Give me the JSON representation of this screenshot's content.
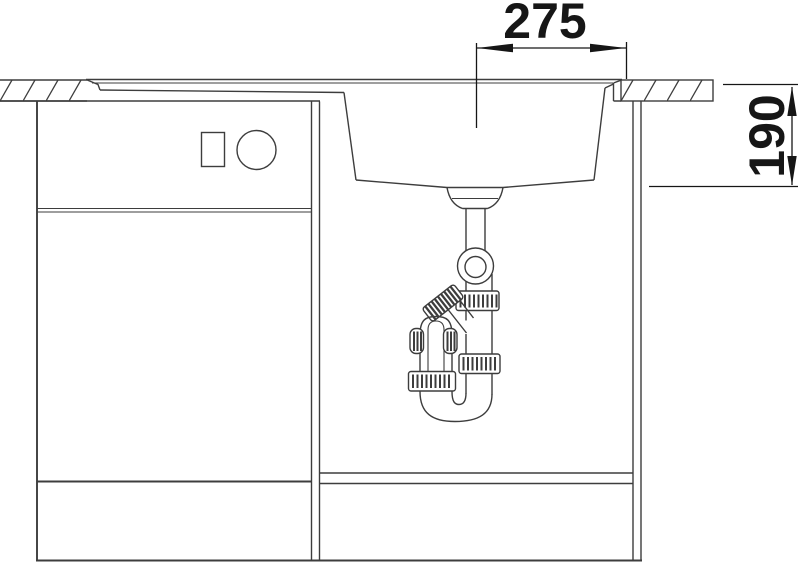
{
  "drawing": {
    "subject": "sink-cabinet-installation-cross-section",
    "dimension_width": {
      "value": "275"
    },
    "dimension_depth": {
      "value": "190"
    },
    "colors": {
      "background": "#ffffff",
      "line": "#3d3d3d",
      "dimension": "#161616"
    }
  }
}
